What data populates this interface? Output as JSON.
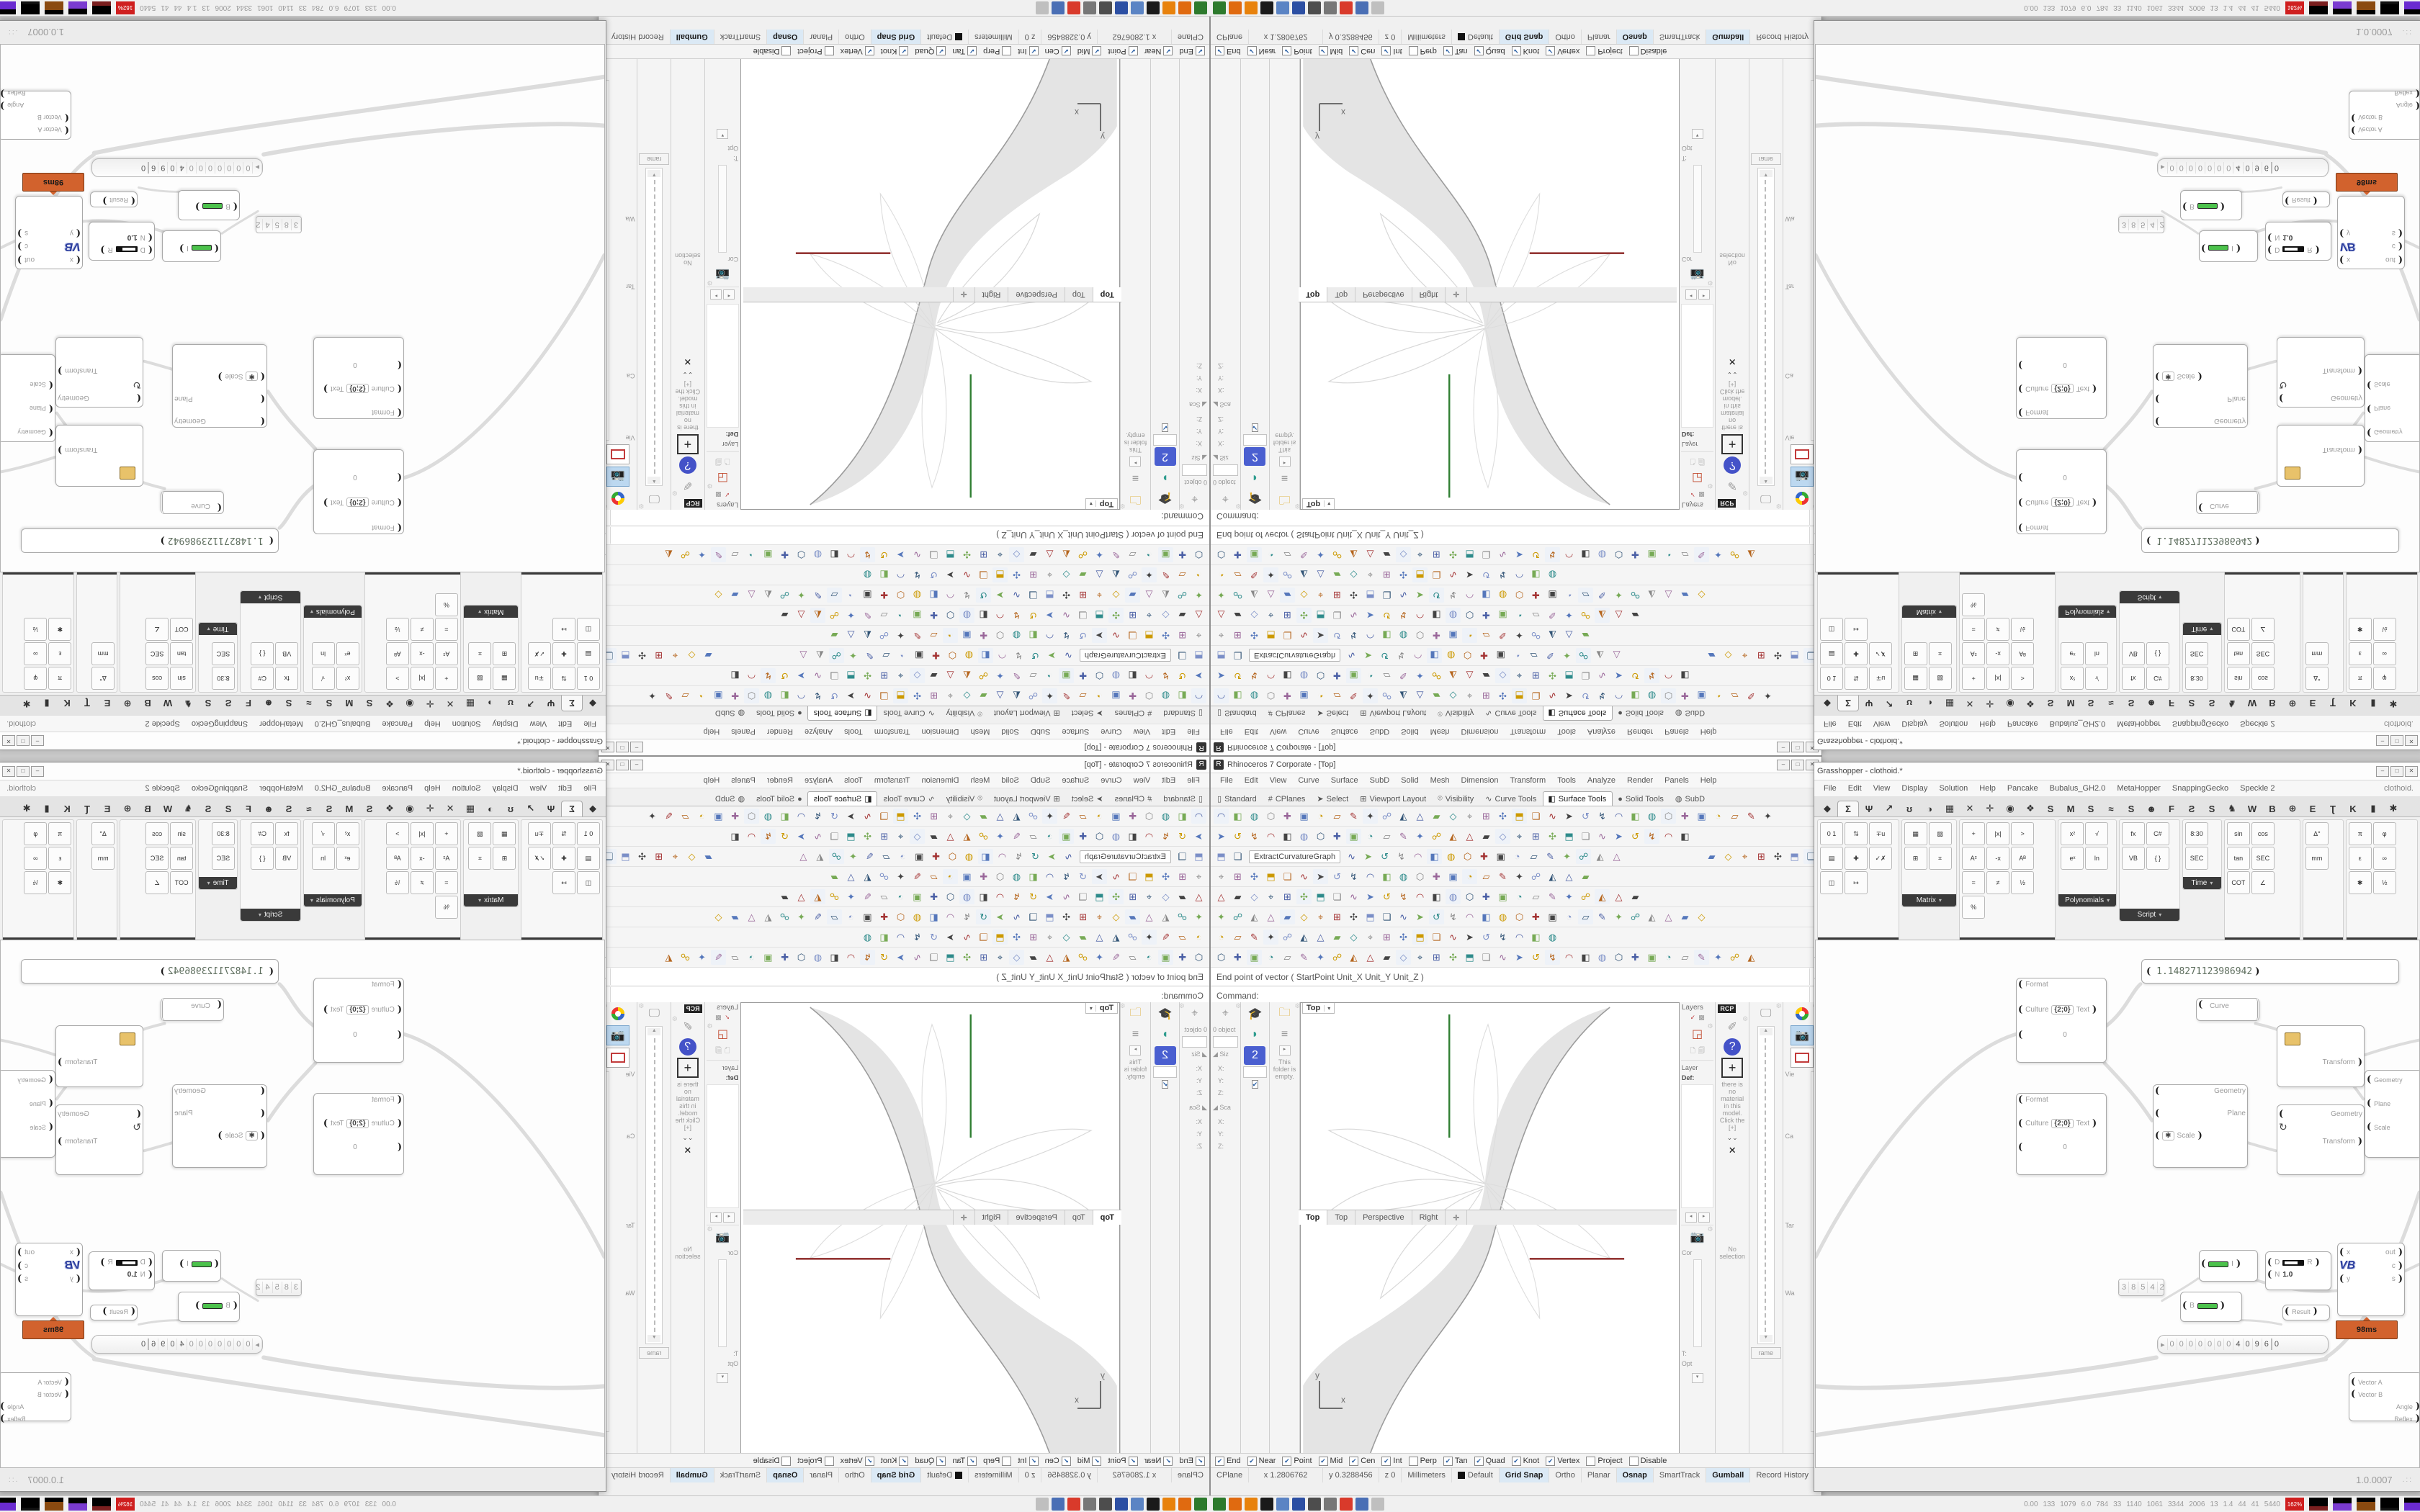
{
  "rhino": {
    "title": "Rhinoceros 7 Corporate - [Top]",
    "caption_buttons": [
      "–",
      "□",
      "✕"
    ],
    "menus": [
      "File",
      "Edit",
      "View",
      "Curve",
      "Surface",
      "SubD",
      "Solid",
      "Mesh",
      "Dimension",
      "Transform",
      "Tools",
      "Analyze",
      "Render",
      "Panels",
      "Help"
    ],
    "toolbar_tabs": [
      {
        "label": "Standard",
        "glyph": "▯",
        "active": false
      },
      {
        "label": "CPlanes",
        "glyph": "#",
        "active": false
      },
      {
        "label": "Select",
        "glyph": "➤",
        "active": false
      },
      {
        "label": "Viewport Layout",
        "glyph": "⊞",
        "active": false
      },
      {
        "label": "Visibility",
        "glyph": "⌾",
        "active": false
      },
      {
        "label": "Curve Tools",
        "glyph": "∿",
        "active": false
      },
      {
        "label": "Surface Tools",
        "glyph": "◧",
        "active": true
      },
      {
        "label": "Solid Tools",
        "glyph": "●",
        "active": false
      },
      {
        "label": "SubD",
        "glyph": "◍",
        "active": false
      }
    ],
    "toolbar_rows": [
      34,
      29,
      26,
      23,
      26,
      30,
      21,
      33
    ],
    "extract_button": "ExtractCurvatureGraph",
    "command_history": "End point of vector ( StartPoint  Unit_X  Unit_Y  Unit_Z )",
    "command_prompt": "Command:",
    "left_dock": {
      "objects_label": "0 object",
      "input_label": "A",
      "size_label": "Siz",
      "scale_label": "Sca",
      "fields": [
        "X:",
        "Y:",
        "Z:"
      ],
      "empty_folder_text": "This folder is empty.",
      "checkbox": "✔"
    },
    "viewport": {
      "minitab": "Top",
      "dd": "▾",
      "axis_x": "x",
      "axis_y": "y"
    },
    "viewport_tabs": [
      {
        "label": "Top",
        "active": true
      },
      {
        "label": "Top",
        "active": false
      },
      {
        "label": "Perspective",
        "active": false
      },
      {
        "label": "Right",
        "active": false
      },
      {
        "label": "✛",
        "active": false
      }
    ],
    "right_dock": {
      "layers_title": "Layers",
      "layer_header": "Layer",
      "layer_default": "Def:",
      "rcp": "RCP",
      "mat_text": "there is no material in this model. Click the [+]",
      "no_selection": "No selection",
      "wireframe": "rame",
      "cam_labels": [
        "Vie",
        "Ca",
        "Tar",
        "Wa"
      ],
      "prop_labels": [
        "Cor",
        "C",
        "T:",
        "Opt"
      ]
    },
    "osnap": [
      {
        "label": "End",
        "checked": true
      },
      {
        "label": "Near",
        "checked": true
      },
      {
        "label": "Point",
        "checked": true
      },
      {
        "label": "Mid",
        "checked": true
      },
      {
        "label": "Cen",
        "checked": true
      },
      {
        "label": "Int",
        "checked": true
      },
      {
        "label": "Perp",
        "checked": false
      },
      {
        "label": "Tan",
        "checked": true
      },
      {
        "label": "Quad",
        "checked": true
      },
      {
        "label": "Knot",
        "checked": true
      },
      {
        "label": "Vertex",
        "checked": true
      },
      {
        "label": "Project",
        "checked": false
      },
      {
        "label": "Disable",
        "checked": false
      }
    ],
    "status": {
      "cplane": "CPlane",
      "x": "x 1.2806762",
      "y": "y 0.3288456",
      "z": "z 0",
      "units": "Millimeters",
      "layer": "Default",
      "toggles": [
        {
          "label": "Grid Snap",
          "on": true
        },
        {
          "label": "Ortho",
          "on": false
        },
        {
          "label": "Planar",
          "on": false
        },
        {
          "label": "Osnap",
          "on": true
        },
        {
          "label": "SmartTrack",
          "on": false
        },
        {
          "label": "Gumball",
          "on": true
        },
        {
          "label": "Record History",
          "on": false
        },
        {
          "label": "Filter",
          "on": false
        }
      ]
    }
  },
  "grasshopper": {
    "title": "Grasshopper - clothoid.*",
    "caption_buttons": [
      "–",
      "□",
      "✕"
    ],
    "menus": [
      "File",
      "Edit",
      "View",
      "Display",
      "Solution",
      "Help",
      "Pancake",
      "Bubalus_GH2.0",
      "MetaHopper",
      "SnappingGecko",
      "Speckle 2"
    ],
    "doc_label": "clothoid.",
    "tabs": [
      {
        "glyph": "◆",
        "name": "params",
        "active": false
      },
      {
        "glyph": "Σ",
        "name": "maths",
        "active": true
      },
      {
        "glyph": "Ψ",
        "name": "sets",
        "active": false
      },
      {
        "glyph": "↗",
        "name": "vector",
        "active": false
      },
      {
        "glyph": "ʊ",
        "name": "curve",
        "active": false
      },
      {
        "glyph": "◑",
        "name": "surface",
        "active": false
      },
      {
        "glyph": "▦",
        "name": "mesh",
        "active": false
      },
      {
        "glyph": "✕",
        "name": "intersect",
        "active": false
      },
      {
        "glyph": "✛",
        "name": "transform",
        "active": false
      },
      {
        "glyph": "◉",
        "name": "display",
        "active": false
      },
      {
        "glyph": "❖",
        "name": "kangaroo",
        "active": false
      },
      {
        "glyph": "S",
        "name": "plugin-s1",
        "active": false
      },
      {
        "glyph": "M",
        "name": "plugin-m",
        "active": false
      },
      {
        "glyph": "S",
        "name": "plugin-s2",
        "active": false
      },
      {
        "glyph": "≈",
        "name": "plugin-wave",
        "active": false
      },
      {
        "glyph": "S",
        "name": "plugin-s3",
        "active": false
      },
      {
        "glyph": "☻",
        "name": "plugin-face",
        "active": false
      },
      {
        "glyph": "F",
        "name": "plugin-f",
        "active": false
      },
      {
        "glyph": "Ƨ",
        "name": "plugin-s4",
        "active": false
      },
      {
        "glyph": "S",
        "name": "plugin-s5",
        "active": false
      },
      {
        "glyph": "♞",
        "name": "plugin-horse",
        "active": false
      },
      {
        "glyph": "W",
        "name": "plugin-w",
        "active": false
      },
      {
        "glyph": "B",
        "name": "plugin-b",
        "active": false
      },
      {
        "glyph": "⊕",
        "name": "plugin-circle",
        "active": false
      },
      {
        "glyph": "E",
        "name": "plugin-e",
        "active": false
      },
      {
        "glyph": "Ʈ",
        "name": "plugin-t",
        "active": false
      },
      {
        "glyph": "K",
        "name": "plugin-k",
        "active": false
      },
      {
        "glyph": "▮",
        "name": "plugin-bar",
        "active": false
      },
      {
        "glyph": "✱",
        "name": "plugin-star",
        "active": false
      }
    ],
    "ribbon_groups": [
      {
        "label": "Domain",
        "items": [
          "0 1",
          "⇅",
          "∓u",
          "▤",
          "✚",
          "✓✗",
          "◫",
          "↦"
        ]
      },
      {
        "label": "Matrix",
        "items": [
          "▦",
          "▨",
          "⊞",
          "⌗"
        ]
      },
      {
        "label": "Operators",
        "items": [
          "+",
          "|x|",
          ">",
          "A²",
          "-x",
          "Aᴮ",
          "=",
          "≠",
          "½",
          "%"
        ]
      },
      {
        "label": "Polynomials",
        "items": [
          "x²",
          "√",
          "eˣ",
          "ln"
        ]
      },
      {
        "label": "Script",
        "items": [
          "fx",
          "C#",
          "VB",
          "{ }"
        ]
      },
      {
        "label": "Time",
        "items": [
          "8:30",
          "SEC"
        ]
      },
      {
        "label": "Trig",
        "items": [
          "sin",
          "cos",
          "tan",
          "SEC",
          "COT",
          "∠"
        ]
      },
      {
        "label": "Units",
        "items": [
          "Δ°",
          "mm"
        ]
      },
      {
        "label": "Util",
        "items": [
          "π",
          "φ",
          "ε",
          "∞",
          "✱",
          "½"
        ]
      }
    ],
    "canvas_toolbar": {
      "zoom": "115%"
    },
    "version": "1.0.0007",
    "nodes": {
      "numbox1": "1.148271123986942",
      "panel_rows": [
        "Format",
        "Culture",
        "{2;0}",
        "Text",
        "0"
      ],
      "curve": "Curve",
      "geometry": "Geometry",
      "plane": "Plane",
      "scale": "Scale",
      "transform": "Transform",
      "remap_out": "I",
      "d_in": "D",
      "d_out": "R",
      "d_val_top": "0.0",
      "d_val_bottom": "1.0",
      "n_in": "N",
      "b_label": "B",
      "vb_in1": "x",
      "vb_in2": "y",
      "vb_label": "VB",
      "vb_out1": "out",
      "vb_out2": "c",
      "vb_out3": "s",
      "profiler_badge": "98ms",
      "digit_cells": [
        "3",
        "8",
        "5",
        "4",
        "2"
      ],
      "scroller_digits": [
        "0",
        "0",
        "0",
        "0",
        "0",
        "0",
        "0",
        "4",
        "0",
        "9",
        "6"
      ],
      "scroller_last": "0",
      "result": "Result",
      "vec_a": "Vector A",
      "vec_b": "Vector B",
      "angle": "Angle",
      "reflex": "Reflex"
    }
  },
  "taskbar": {
    "monitor_values": [
      "0.00",
      "133",
      "1079",
      "6.0",
      "784",
      "33",
      "1140",
      "1061",
      "3344",
      "2006",
      "13",
      "1.4",
      "44",
      "41",
      "5440"
    ],
    "cpu": "162%",
    "icon_colors": [
      "#2d7a2d",
      "#e06a10",
      "#e8820c",
      "#1a1a1a",
      "#5b84c4",
      "#2c4fa3",
      "#4d4d4d",
      "#777777",
      "#d93a2b",
      "#4a6fb5",
      "#bfbfbf"
    ]
  }
}
